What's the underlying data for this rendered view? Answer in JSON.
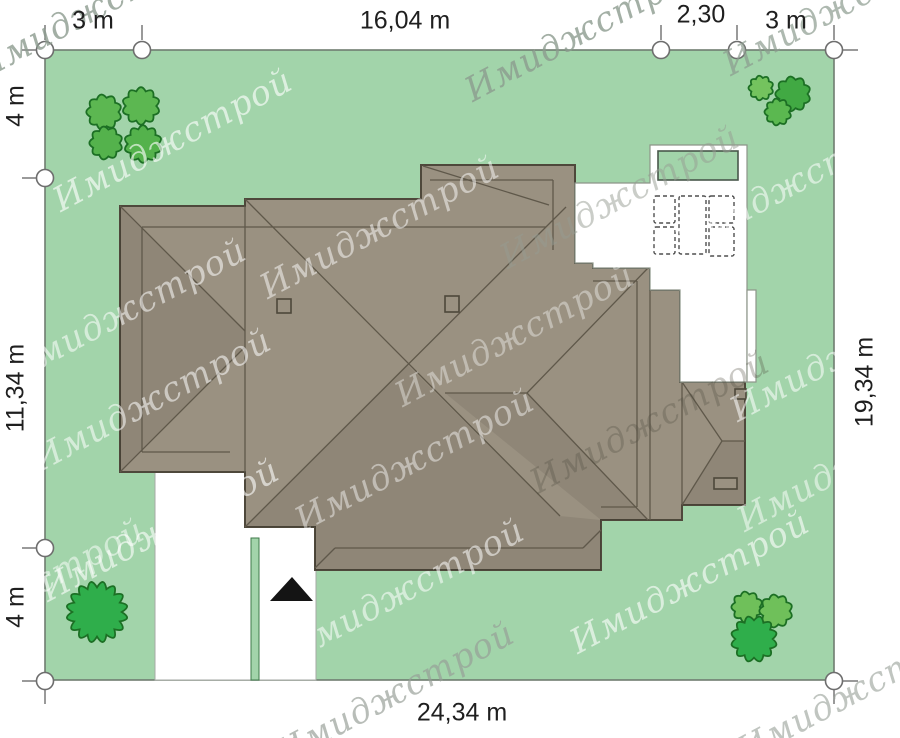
{
  "dimensions": {
    "top_left": "3 m",
    "top_width": "16,04 m",
    "top_pool": "2,30",
    "top_right": "3 m",
    "left_top": "4 m",
    "left_middle": "11,34 m",
    "left_bottom": "4 m",
    "right_side": "19,34 m",
    "bottom_width": "24,34 m"
  },
  "watermark_text": "Имиджстрой",
  "colors": {
    "page_bg": "#ffffff",
    "grass": "#a2d4aa",
    "plot_border": "#6f7c70",
    "roof_fill": "#9a9181",
    "roof_outline": "#4e483b",
    "roof_line": "#5f584a",
    "shade": "rgba(0,0,0,0.07)",
    "white": "#ffffff",
    "terrace_border": "#8d9589",
    "drive_border": "#a6aaa4",
    "divider_border": "#3f7a4a",
    "pool_border": "#49584b",
    "furniture": "#4f4f4f",
    "tree_outline": "#1c6f24",
    "marker_stroke": "#6e6e6e",
    "arrow": "#141414"
  },
  "site_plan": {
    "plot": {
      "x": 45,
      "y": 50,
      "w": 789,
      "h": 630
    },
    "roof": {
      "outline": [
        [
          120,
          206
        ],
        [
          245,
          206
        ],
        [
          245,
          199
        ],
        [
          421,
          199
        ],
        [
          421,
          165
        ],
        [
          575,
          165
        ],
        [
          575,
          263
        ],
        [
          593,
          263
        ],
        [
          593,
          268
        ],
        [
          650,
          268
        ],
        [
          650,
          290
        ],
        [
          680,
          290
        ],
        [
          680,
          382
        ],
        [
          745,
          382
        ],
        [
          745,
          505
        ],
        [
          682,
          505
        ],
        [
          682,
          520
        ],
        [
          601,
          520
        ],
        [
          601,
          570
        ],
        [
          315,
          570
        ],
        [
          315,
          527
        ],
        [
          245,
          527
        ],
        [
          245,
          472
        ],
        [
          120,
          472
        ]
      ],
      "shades": [
        [
          [
            245,
            527
          ],
          [
            407,
            364
          ],
          [
            560,
            516
          ],
          [
            601,
            520
          ],
          [
            601,
            570
          ],
          [
            315,
            570
          ],
          [
            315,
            527
          ]
        ],
        [
          [
            445,
            393
          ],
          [
            527,
            393
          ],
          [
            648,
            520
          ],
          [
            601,
            520
          ]
        ],
        [
          [
            120,
            206
          ],
          [
            245,
            331
          ],
          [
            245,
            347
          ],
          [
            120,
            472
          ]
        ],
        [
          [
            682,
            505
          ],
          [
            722,
            441
          ],
          [
            745,
            441
          ],
          [
            745,
            505
          ]
        ]
      ],
      "lines": [
        [
          245,
          206,
          245,
          472
        ],
        [
          120,
          206,
          245,
          331
        ],
        [
          120,
          472,
          245,
          347
        ],
        [
          142,
          227,
          142,
          452
        ],
        [
          142,
          227,
          546,
          227
        ],
        [
          142,
          452,
          230,
          452
        ],
        [
          245,
          199,
          560,
          516
        ],
        [
          245,
          527,
          566,
          207
        ],
        [
          423,
          166,
          549,
          205
        ],
        [
          430,
          180,
          553,
          180
        ],
        [
          553,
          180,
          553,
          250
        ],
        [
          648,
          268,
          527,
          393
        ],
        [
          648,
          520,
          527,
          393
        ],
        [
          527,
          393,
          445,
          393
        ],
        [
          593,
          281,
          637,
          281
        ],
        [
          637,
          281,
          637,
          507
        ],
        [
          601,
          507,
          637,
          507
        ],
        [
          650,
          290,
          650,
          520
        ],
        [
          335,
          548,
          583,
          548
        ],
        [
          315,
          568,
          335,
          548
        ],
        [
          583,
          548,
          601,
          530
        ],
        [
          682,
          382,
          682,
          505
        ],
        [
          682,
          382,
          722,
          441
        ],
        [
          682,
          505,
          722,
          441
        ],
        [
          722,
          441,
          745,
          441
        ]
      ],
      "chimneys": [
        [
          277,
          299,
          14,
          14
        ],
        [
          445,
          296,
          14,
          16
        ],
        [
          735,
          389,
          11,
          10
        ]
      ],
      "vents": [
        [
          714,
          478,
          23,
          11
        ]
      ]
    },
    "terrace": {
      "outline": [
        [
          575,
          183
        ],
        [
          650,
          183
        ],
        [
          650,
          145
        ],
        [
          747,
          145
        ],
        [
          747,
          382
        ],
        [
          680,
          382
        ],
        [
          680,
          290
        ],
        [
          650,
          290
        ],
        [
          650,
          268
        ],
        [
          593,
          268
        ],
        [
          593,
          263
        ],
        [
          575,
          263
        ]
      ],
      "pool": [
        658,
        151,
        80,
        29
      ],
      "side_tab": [
        747,
        290,
        9,
        92
      ],
      "furniture": [
        [
          654,
          196,
          21,
          27
        ],
        [
          654,
          227,
          21,
          27
        ],
        [
          679,
          196,
          27,
          58
        ],
        [
          709,
          196,
          25,
          27
        ],
        [
          709,
          227,
          25,
          29
        ]
      ]
    },
    "driveway": {
      "outline": [
        [
          155,
          472
        ],
        [
          245,
          472
        ],
        [
          245,
          527
        ],
        [
          316,
          527
        ],
        [
          316,
          680
        ],
        [
          155,
          680
        ]
      ],
      "divider": [
        251,
        538,
        8,
        142
      ],
      "arrow": [
        [
          292,
          577
        ],
        [
          313,
          601
        ],
        [
          270,
          601
        ]
      ]
    },
    "trees": [
      {
        "cx": 104,
        "cy": 112,
        "r": 17,
        "fill": "#5cb751"
      },
      {
        "cx": 141,
        "cy": 106,
        "r": 18,
        "fill": "#5cb751"
      },
      {
        "cx": 106,
        "cy": 143,
        "r": 16,
        "fill": "#54b24c"
      },
      {
        "cx": 143,
        "cy": 144,
        "r": 18,
        "fill": "#54b24c"
      },
      {
        "cx": 761,
        "cy": 88,
        "r": 12,
        "fill": "#74c35e"
      },
      {
        "cx": 793,
        "cy": 94,
        "r": 17,
        "fill": "#41a943"
      },
      {
        "cx": 778,
        "cy": 112,
        "r": 13,
        "fill": "#5bb850"
      },
      {
        "cx": 97,
        "cy": 612,
        "r": 29,
        "fill": "#2fae4b"
      },
      {
        "cx": 747,
        "cy": 607,
        "r": 15,
        "fill": "#6fc05a"
      },
      {
        "cx": 776,
        "cy": 611,
        "r": 16,
        "fill": "#6fc05a"
      },
      {
        "cx": 754,
        "cy": 639,
        "r": 22,
        "fill": "#2fae4b"
      }
    ],
    "markers": {
      "circles": [
        [
          45,
          50
        ],
        [
          142,
          50
        ],
        [
          661,
          50
        ],
        [
          737,
          50
        ],
        [
          834,
          50
        ],
        [
          45,
          178
        ],
        [
          45,
          548
        ],
        [
          45,
          681
        ],
        [
          834,
          681
        ]
      ],
      "radius": 8.5,
      "ticks": [
        [
          45,
          40,
          45,
          25
        ],
        [
          37,
          50,
          22,
          50
        ],
        [
          142,
          40,
          142,
          25
        ],
        [
          661,
          40,
          661,
          25
        ],
        [
          737,
          40,
          737,
          25
        ],
        [
          834,
          40,
          834,
          25
        ],
        [
          842,
          50,
          858,
          50
        ],
        [
          37,
          178,
          22,
          178
        ],
        [
          37,
          548,
          22,
          548
        ],
        [
          37,
          681,
          22,
          681
        ],
        [
          45,
          689,
          45,
          704
        ],
        [
          842,
          681,
          858,
          681
        ],
        [
          834,
          689,
          834,
          704
        ]
      ]
    },
    "watermarks": [
      {
        "x": 100,
        "y": 18,
        "c": "rgba(140,155,143,0.8)"
      },
      {
        "x": 590,
        "y": 40,
        "c": "rgba(140,155,143,0.8)"
      },
      {
        "x": 848,
        "y": 14,
        "c": "rgba(140,155,143,0.7)"
      },
      {
        "x": 178,
        "y": 150,
        "c": "rgba(255,255,255,0.62)"
      },
      {
        "x": 800,
        "y": 192,
        "c": "rgba(255,255,255,0.55)"
      },
      {
        "x": 385,
        "y": 237,
        "c": "rgba(255,255,255,0.5)"
      },
      {
        "x": 625,
        "y": 207,
        "c": "rgba(150,155,145,0.5)"
      },
      {
        "x": 132,
        "y": 320,
        "c": "rgba(255,255,255,0.55)"
      },
      {
        "x": 520,
        "y": 345,
        "c": "rgba(255,255,255,0.38)"
      },
      {
        "x": 855,
        "y": 360,
        "c": "rgba(255,255,255,0.55)"
      },
      {
        "x": 157,
        "y": 410,
        "c": "rgba(255,255,255,0.55)"
      },
      {
        "x": 420,
        "y": 470,
        "c": "rgba(255,255,255,0.45)"
      },
      {
        "x": 655,
        "y": 432,
        "c": "rgba(80,75,62,0.3)"
      },
      {
        "x": 862,
        "y": 470,
        "c": "rgba(255,255,255,0.5)"
      },
      {
        "x": 165,
        "y": 540,
        "c": "rgba(255,255,255,0.6)"
      },
      {
        "x": 410,
        "y": 600,
        "c": "rgba(255,255,255,0.55)"
      },
      {
        "x": 695,
        "y": 592,
        "c": "rgba(255,255,255,0.6)"
      },
      {
        "x": 400,
        "y": 703,
        "c": "rgba(150,158,150,0.68)"
      },
      {
        "x": 862,
        "y": 700,
        "c": "rgba(150,158,150,0.6)"
      },
      {
        "x": 30,
        "y": 600,
        "c": "rgba(255,255,255,0.5)"
      }
    ]
  }
}
